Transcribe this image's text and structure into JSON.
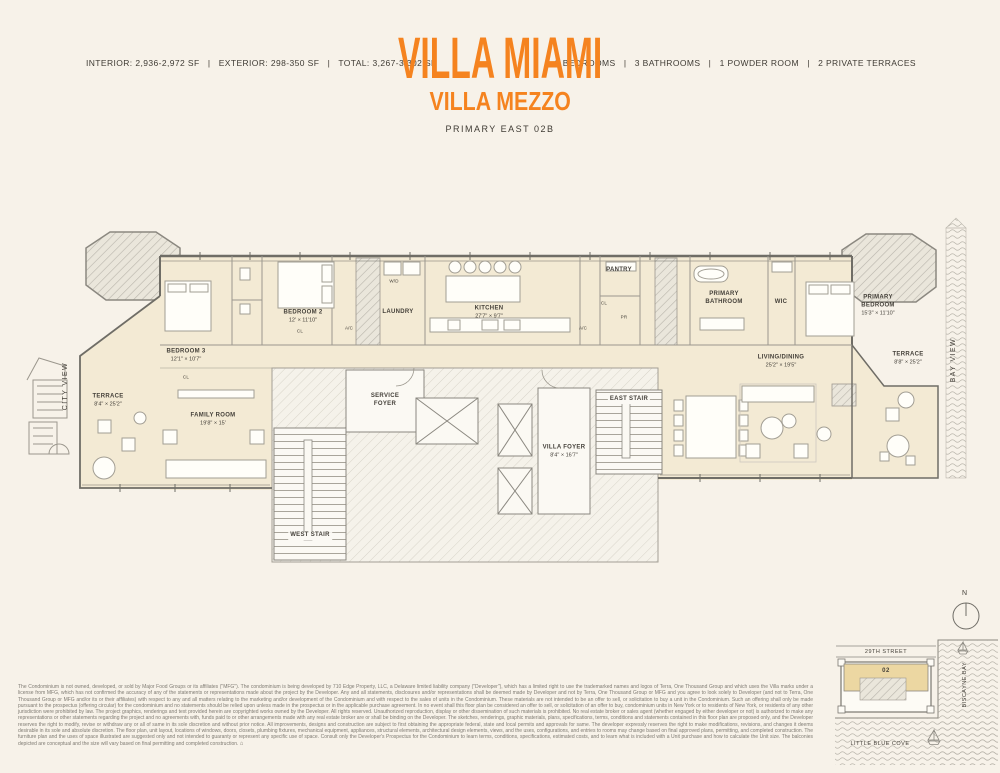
{
  "header": {
    "stats_left": "INTERIOR: 2,936-2,972 SF   |   EXTERIOR: 298-350 SF   |   TOTAL: 3,267-3,302 SF",
    "title": "VILLA MIAMI",
    "subtitle": "VILLA MEZZO",
    "plan_name": "PRIMARY EAST 02B",
    "stats_right": "3 BEDROOMS   |   3 BATHROOMS   |   1 POWDER ROOM   |   2 PRIVATE TERRACES"
  },
  "colors": {
    "accent": "#F5831F",
    "ink": "#3E3A33",
    "background": "#F7F2E9",
    "floor_fill": "#F3EAD4",
    "wall": "#6F6D66",
    "sitemap_unit_fill": "#ECD7A2"
  },
  "floorplan": {
    "view_labels": {
      "left": "CITY VIEW",
      "right": "BAY VIEW"
    },
    "rooms": {
      "terrace_west": {
        "name": "TERRACE",
        "dims": "8'4\" × 25'2\""
      },
      "bedroom3": {
        "name": "BEDROOM 3",
        "dims": "12'1\" × 10'7\""
      },
      "family_room": {
        "name": "FAMILY ROOM",
        "dims": "19'8\" × 15'"
      },
      "bedroom2": {
        "name": "BEDROOM 2",
        "dims": "12' × 11'10\""
      },
      "laundry": {
        "name": "LAUNDRY"
      },
      "kitchen": {
        "name": "KITCHEN",
        "dims": "27'7\" × 9'7\""
      },
      "pantry": {
        "name": "PANTRY"
      },
      "service_foyer": {
        "name": "SERVICE FOYER"
      },
      "villa_foyer": {
        "name": "VILLA FOYER",
        "dims": "8'4\" × 16'7\""
      },
      "east_stair": {
        "name": "EAST STAIR"
      },
      "west_stair": {
        "name": "WEST STAIR"
      },
      "primary_bathroom": {
        "name": "PRIMARY BATHROOM"
      },
      "wic": {
        "name": "WIC"
      },
      "primary_bedroom": {
        "name": "PRIMARY BEDROOM",
        "dims": "15'3\" × 11'10\""
      },
      "living_dining": {
        "name": "LIVING/DINING",
        "dims": "25'2\" × 19'5\""
      },
      "terrace_east": {
        "name": "TERRACE",
        "dims": "8'8\" × 25'2\""
      }
    },
    "small_labels": {
      "cl_bedroom3": "CL",
      "cl_bedroom2": "CL",
      "ac_west": "A/C",
      "wd": "W/D",
      "cl_hall": "CL",
      "powder": "PR",
      "ac_east": "A/C"
    }
  },
  "sitemap": {
    "north_label": "N",
    "street": "29TH STREET",
    "bay": "BISCAYNE BAY",
    "cove": "LITTLE BLUE COVE",
    "unit_number": "02"
  },
  "icons": {
    "equal_housing": "⌂"
  },
  "disclaimer": {
    "text": "The Condominium is not owned, developed, or sold by Major Food Groups or its affiliates (\"MFG\"). The condominium is being developed by 710 Edge Property, LLC, a Delaware limited liability company (\"Developer\"), which has a limited right to use the trademarked names and logos of Terra, One Thousand Group and which uses the Villa marks under a license from MFG, which has not confirmed the accuracy of any of the statements or representations made about the project by the Developer. Any and all statements, disclosures and/or representations shall be deemed made by Developer and not by Terra, One Thousand Group or MFG and you agree to look solely to Developer (and not to Terra, One Thousand Group or MFG and/or its or their affiliates) with respect to any and all matters relating to the marketing and/or development of the Condominium and with respect to the sales of units in the Condominium. These materials are not intended to be an offer to sell, or solicitation to buy a unit in the Condominium. Such an offering shall only be made pursuant to the prospectus (offering circular) for the condominium and no statements should be relied upon unless made in the prospectus or in the applicable purchase agreement. In no event shall this floor plan be considered an offer to sell, or solicitation of an offer to buy, condominium units in New York or to residents of New York, or residents of any other jurisdiction were prohibited by law. The project graphics, renderings and text provided herein are copyrighted works owned by the Developer. All rights reserved. Unauthorized reproduction, display or other dissemination of such materials is prohibited. No real estate broker or sales agent (whether engaged by either developer or not) is authorized to make any representations or other statements regarding the project and no agreements with, funds paid to or other arrangements made with any real estate broker are or shall be binding on the Developer. The sketches, renderings, graphic materials, plans, specifications, terms, conditions and statements contained in this floor plan are proposed only, and the Developer reserves the right to modify, revise or withdraw any or all of same in its sole discretion and without prior notice. All improvements, designs and construction are subject to first obtaining the appropriate federal, state and local permits and approvals for same. The developer expressly reserves the right to make modifications, revisions, and changes it deems desirable in its sole and absolute discretion. The floor plan, unit layout, locations of windows, doors, closets, plumbing fixtures, mechanical equipment, appliances, structural elements, architectural design elements, views, and the uses, configurations, and entries to rooms may change based on final approved plans, permitting, and completed construction. The furniture plan and the uses of space illustrated are suggested only and not intended to guaranty or represent any specific use of space. Consult only the Developer's Prospectus for the Condominium to learn terms, conditions, specifications, estimated costs, and to learn what is included with a Unit purchase and how to calculate the Unit size. The balconies depicted are conceptual and the size will vary based on final permitting and completed construction."
  }
}
